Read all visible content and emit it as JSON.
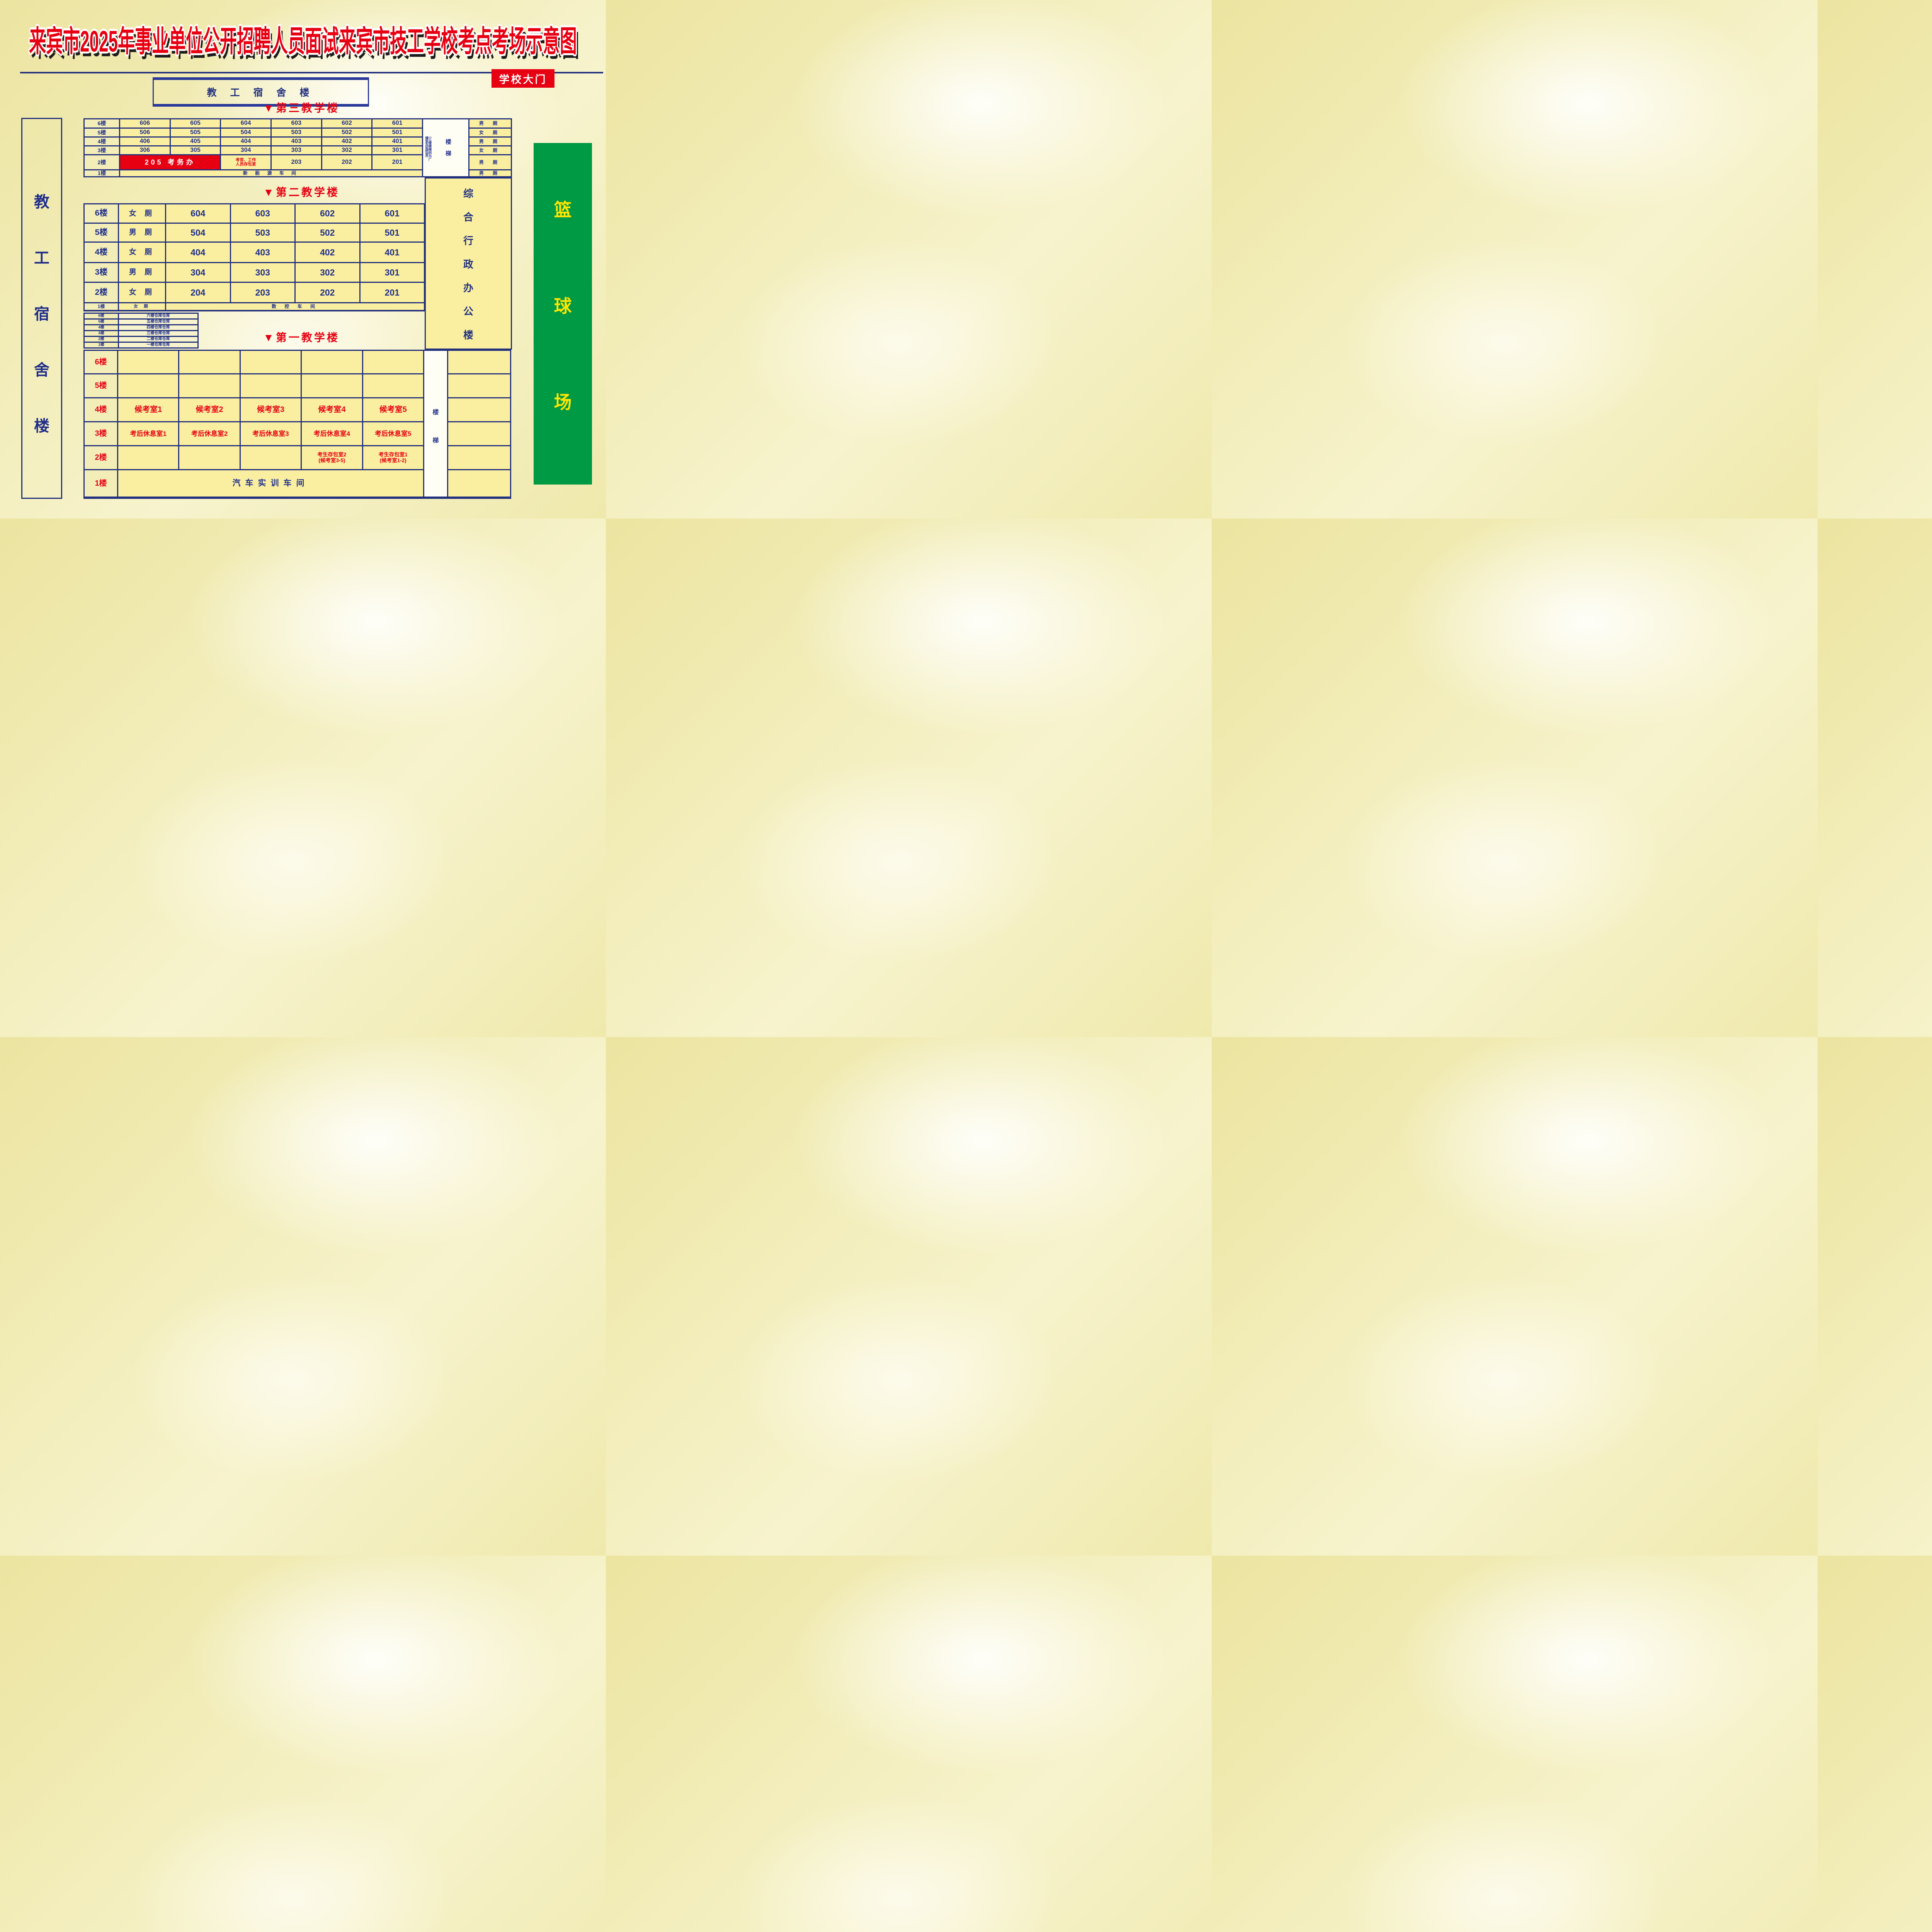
{
  "title": "来宾市2025年事业单位公开招聘人员面试来宾市技工学校考点考场示意图",
  "school_gate": "学校大门",
  "dorm_band": "教 工 宿 舍 楼",
  "left_dorm_chars": [
    "教",
    "工",
    "宿",
    "舍",
    "楼"
  ],
  "admin_chars": [
    "综",
    "合",
    "行",
    "政",
    "办",
    "公",
    "楼"
  ],
  "court_chars": [
    "篮",
    "球",
    "场"
  ],
  "b3": {
    "header": "▼第三教学楼",
    "floors": [
      "6楼",
      "5楼",
      "4楼",
      "3楼",
      "2楼",
      "1楼"
    ],
    "rooms6": [
      "606",
      "605",
      "604",
      "603",
      "602",
      "601"
    ],
    "rooms5": [
      "506",
      "505",
      "504",
      "503",
      "502",
      "501"
    ],
    "rooms4": [
      "406",
      "405",
      "404",
      "403",
      "402",
      "401"
    ],
    "rooms3": [
      "306",
      "305",
      "304",
      "303",
      "302",
      "301"
    ],
    "exam_office": "205 考务办",
    "staff_storage_l1": "考官、工作",
    "staff_storage_l2": "人员存包室",
    "rooms2": [
      "203",
      "202",
      "201"
    ],
    "workshop1": "新 能 源 车 间",
    "stair_note": "（三楼楼梯间为广播室及监控室）",
    "stairs": [
      "楼",
      "梯"
    ],
    "toilets": [
      "男  厕",
      "女  厕",
      "男  厕",
      "女  厕",
      "男  厕",
      "男  厕"
    ]
  },
  "b2": {
    "header": "▼第二教学楼",
    "floors": [
      "6楼",
      "5楼",
      "4楼",
      "3楼",
      "2楼",
      "1楼"
    ],
    "toilets": [
      "女 厕",
      "男 厕",
      "女 厕",
      "男 厕",
      "女 厕",
      "女  厕"
    ],
    "rooms6": [
      "604",
      "603",
      "602",
      "601"
    ],
    "rooms5": [
      "504",
      "503",
      "502",
      "501"
    ],
    "rooms4": [
      "404",
      "403",
      "402",
      "401"
    ],
    "rooms3": [
      "304",
      "303",
      "302",
      "301"
    ],
    "rooms2": [
      "204",
      "203",
      "202",
      "201"
    ],
    "workshop1": "数 控 车 间"
  },
  "warehouse": {
    "floors": [
      "6楼",
      "5楼",
      "4楼",
      "3楼",
      "2楼",
      "1楼"
    ],
    "cells": [
      "六楼仓库仓库",
      "五楼仓库仓库",
      "四楼仓库仓库",
      "三楼仓库仓库",
      "二楼仓库仓库",
      "一楼仓库仓库"
    ]
  },
  "b1": {
    "header": "▼第一教学楼",
    "floors": [
      "6楼",
      "5楼",
      "4楼",
      "3楼",
      "2楼",
      "1楼"
    ],
    "waiting": [
      "候考室1",
      "候考室2",
      "候考室3",
      "候考室4",
      "候考室5"
    ],
    "rest": [
      "考后休息室1",
      "考后休息室2",
      "考后休息室3",
      "考后休息室4",
      "考后休息室5"
    ],
    "bag2_l1": "考生存包室2",
    "bag2_l2": "(候考室3-5)",
    "bag1_l1": "考生存包室1",
    "bag1_l2": "(候考室1-2)",
    "workshop1": "汽车实训车间",
    "stairs": [
      "楼",
      "梯"
    ]
  }
}
